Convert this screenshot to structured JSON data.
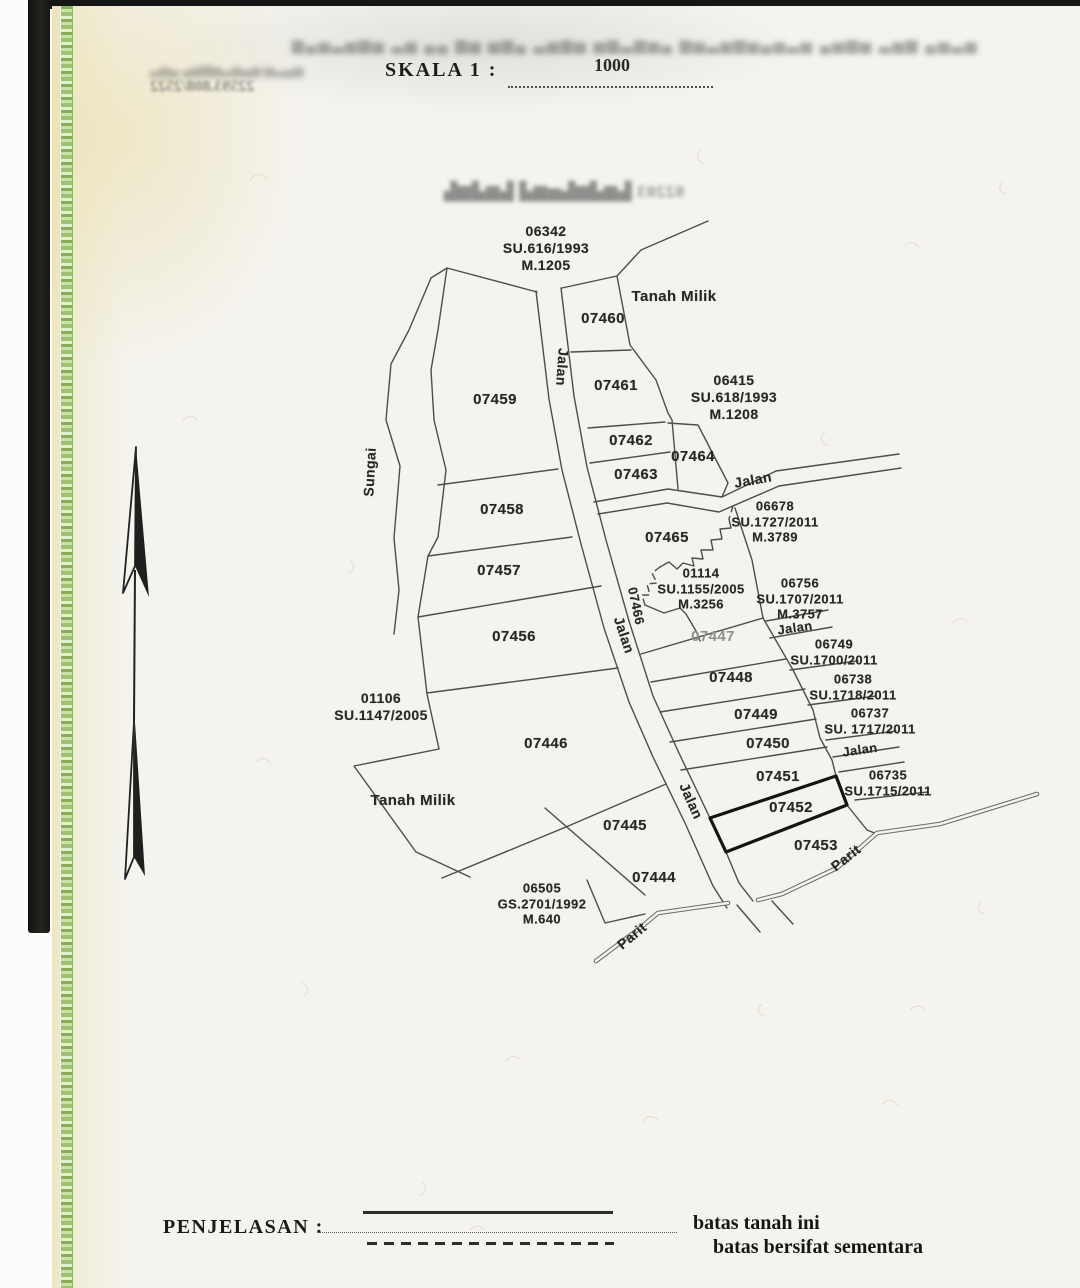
{
  "header": {
    "skala_label": "SKALA 1 :",
    "skala_value": "1000"
  },
  "bleedthrough": {
    "banner": "▆▄▅▃▅▆▅ ▃▅ ▄▄ ▆▅ ▅▆▄ ▃▅▆▅ ▅▆▃▆▅▄ ▆▅▃▅▆▅▄▅▃▅ ▄▅▆▅ ▃▅▆ ▄▅▃▅",
    "stamp_line1": "▃▅▄ ▄▅▆▅▃▅▄▅ ▅▃▄▅",
    "stamp_line2": "22593.808/2522",
    "mid": "02203 ▙▆▟▆▙▅▆▟ ▙▆▟▆▙"
  },
  "legend": {
    "title": "PENJELASAN :",
    "items": [
      {
        "sample": "solid-line",
        "label": "batas tanah ini"
      },
      {
        "sample": "dashed-line",
        "label": "batas bersifat sementara"
      }
    ]
  },
  "map": {
    "labels": [
      {
        "text": "06342\nSU.616/1993\nM.1205",
        "x": 546,
        "y": 248,
        "size": 14
      },
      {
        "text": "Tanah Milik",
        "x": 674,
        "y": 297,
        "size": 15
      },
      {
        "text": "07460",
        "x": 603,
        "y": 319,
        "size": 15
      },
      {
        "text": "Jalan",
        "x": 562,
        "y": 367,
        "rot": 94,
        "size": 14
      },
      {
        "text": "07461",
        "x": 616,
        "y": 386,
        "size": 15
      },
      {
        "text": "06415\nSU.618/1993\nM.1208",
        "x": 734,
        "y": 397,
        "size": 14
      },
      {
        "text": "07459",
        "x": 495,
        "y": 400,
        "size": 15
      },
      {
        "text": "07462",
        "x": 631,
        "y": 441,
        "size": 15
      },
      {
        "text": "07464",
        "x": 693,
        "y": 457,
        "size": 15
      },
      {
        "text": "Sungai",
        "x": 370,
        "y": 472,
        "rot": -87,
        "size": 14
      },
      {
        "text": "07463",
        "x": 636,
        "y": 475,
        "size": 15
      },
      {
        "text": "Jalan",
        "x": 753,
        "y": 480,
        "rot": -10,
        "size": 14
      },
      {
        "text": "07458",
        "x": 502,
        "y": 510,
        "size": 15
      },
      {
        "text": "06678\nSU.1727/2011\nM.3789",
        "x": 775,
        "y": 522,
        "size": 13
      },
      {
        "text": "07465",
        "x": 667,
        "y": 538,
        "size": 15
      },
      {
        "text": "07457",
        "x": 499,
        "y": 571,
        "size": 15
      },
      {
        "text": "01114\nSU.1155/2005\nM.3256",
        "x": 701,
        "y": 589,
        "size": 13
      },
      {
        "text": "06756\nSU.1707/2011\nM.3757",
        "x": 800,
        "y": 599,
        "size": 13
      },
      {
        "text": "07466",
        "x": 636,
        "y": 606,
        "rot": 78,
        "size": 13
      },
      {
        "text": "Jalan",
        "x": 624,
        "y": 635,
        "rot": 72,
        "size": 14
      },
      {
        "text": "Jalan",
        "x": 795,
        "y": 628,
        "rot": -8,
        "size": 13
      },
      {
        "text": "07456",
        "x": 514,
        "y": 637,
        "size": 15
      },
      {
        "text": "07447",
        "x": 713,
        "y": 637,
        "muted": true,
        "size": 15
      },
      {
        "text": "06749\nSU.1700/2011",
        "x": 834,
        "y": 652,
        "size": 13
      },
      {
        "text": "07448",
        "x": 731,
        "y": 678,
        "size": 15
      },
      {
        "text": "06738\nSU.1718/2011",
        "x": 853,
        "y": 687,
        "size": 13
      },
      {
        "text": "01106\nSU.1147/2005",
        "x": 381,
        "y": 707,
        "size": 14
      },
      {
        "text": "07449",
        "x": 756,
        "y": 715,
        "size": 15
      },
      {
        "text": "06737\nSU. 1717/2011",
        "x": 870,
        "y": 721,
        "size": 13
      },
      {
        "text": "07446",
        "x": 546,
        "y": 744,
        "size": 15
      },
      {
        "text": "07450",
        "x": 768,
        "y": 744,
        "size": 15
      },
      {
        "text": "Jalan",
        "x": 860,
        "y": 750,
        "rot": -8,
        "size": 13
      },
      {
        "text": "07451",
        "x": 778,
        "y": 777,
        "size": 15
      },
      {
        "text": "06735\nSU.1715/2011",
        "x": 888,
        "y": 783,
        "size": 13
      },
      {
        "text": "Tanah Milik",
        "x": 413,
        "y": 801,
        "size": 15
      },
      {
        "text": "Jalan",
        "x": 691,
        "y": 801,
        "rot": 66,
        "size": 14
      },
      {
        "text": "07452",
        "x": 791,
        "y": 808,
        "size": 15
      },
      {
        "text": "07445",
        "x": 625,
        "y": 826,
        "size": 15
      },
      {
        "text": "07453",
        "x": 816,
        "y": 846,
        "size": 15
      },
      {
        "text": "Parit",
        "x": 846,
        "y": 858,
        "rot": -38,
        "size": 14
      },
      {
        "text": "07444",
        "x": 654,
        "y": 878,
        "size": 15
      },
      {
        "text": "06505\nGS.2701/1992\nM.640",
        "x": 542,
        "y": 904,
        "size": 13
      },
      {
        "text": "Parit",
        "x": 632,
        "y": 936,
        "rot": -40,
        "size": 14
      }
    ]
  }
}
